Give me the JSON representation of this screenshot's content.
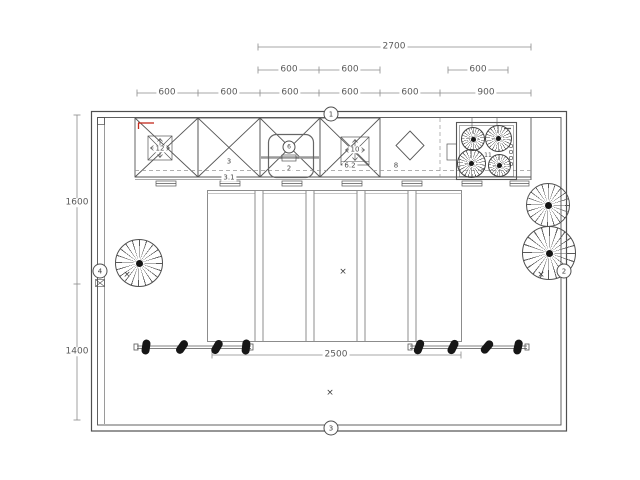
{
  "drawing": {
    "kind": "kitchen floor plan",
    "colors": {
      "line": "#4f4f4f",
      "dimension_line": "#8a8a8a",
      "light_line": "#8c8c8c",
      "accent_red": "#c22a1c",
      "spotlight_black": "#161616",
      "background": "#ffffff"
    }
  },
  "dimensions": {
    "top_row1": [
      {
        "label": "2700"
      }
    ],
    "top_row2": [
      {
        "label": "600"
      },
      {
        "label": "600"
      },
      {
        "label": "600"
      }
    ],
    "top_row3": [
      {
        "label": "600"
      },
      {
        "label": "600"
      },
      {
        "label": "600"
      },
      {
        "label": "600"
      },
      {
        "label": "600"
      },
      {
        "label": "900"
      }
    ],
    "left_col": [
      {
        "label": "1600"
      },
      {
        "label": "1400"
      }
    ],
    "center": [
      {
        "label": "2500"
      }
    ]
  },
  "wall_markers": [
    {
      "label": "1"
    },
    {
      "label": "2"
    },
    {
      "label": "3"
    },
    {
      "label": "4"
    }
  ],
  "item_labels": {
    "cabinet_3": "3",
    "cabinet_3_sub": "3.1",
    "sink_circle": "6",
    "sink_num": "2",
    "spot_box_left": "12",
    "spot_box_right": "10",
    "spot_box_right_sub": "6.2",
    "corner_cabinet": "8",
    "hob": "11"
  },
  "icons": {
    "cross_marker": "×",
    "plus_marker": "+"
  }
}
